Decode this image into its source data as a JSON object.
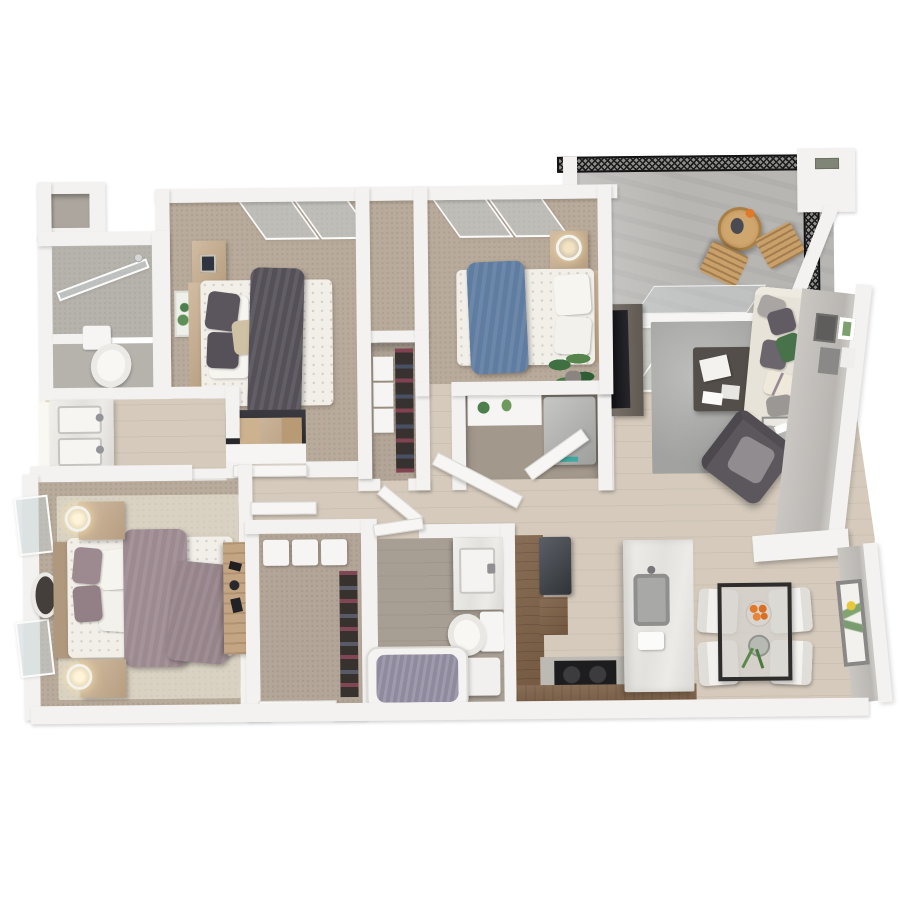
{
  "meta": {
    "title": "3D top-down floor plan render — apartment with three bedrooms, two bathrooms, balcony, open kitchen and living-dining area",
    "render_type": "architectural-3d-floorplan",
    "visible_text": "none"
  },
  "palette": {
    "background": "#ffffff",
    "wall": "#f3f2f0",
    "bedroom_carpet": "#b9ab9b",
    "hall_living_wood": "#d5cabc",
    "bathroom_plank": "#a89f94",
    "balcony_concrete": "#b7b6b3",
    "living_rug": "#a2a2a0",
    "master_rug": "#d9d2c3",
    "kitchen_cabinet_wood": "#7b5d43",
    "island_marble": "#eceae6",
    "appliance_dark": "#3c4046",
    "bed1_throw_charcoal": "#555058",
    "bed2_throw_blue": "#5f7da1",
    "master_throw_mauve": "#9c8a90",
    "sofa_cream": "#e8e3d8",
    "accent_green": "#47724a",
    "furniture_wood": "#c6ab8b",
    "glass": "#c5cfd3",
    "railing_mesh": "#1c1c1c",
    "orange_accent": "#e0792a",
    "tub_mat_purple": "#8f8b9e"
  },
  "rooms": [
    {
      "id": "bedroom-1",
      "label": "Bedroom 1 (top left)",
      "floor": "carpet",
      "furniture": [
        "double bed with charcoal draped throw",
        "two dark gray pillows",
        "tan pillow",
        "wood headboard",
        "nightstand with clock",
        "green wall art",
        "wood shelf with green box",
        "desk with dark top and wood organizers",
        "white sliding closet door",
        "two slanted window panes"
      ]
    },
    {
      "id": "bedroom-2",
      "label": "Bedroom 2 (top middle)",
      "floor": "carpet",
      "furniture": [
        "double bed with blue draped throw",
        "white pillows",
        "wood headboard",
        "nightstand with glowing lamp",
        "potted green plant",
        "two slanted window panes"
      ]
    },
    {
      "id": "balcony",
      "label": "Balcony (top right)",
      "floor": "concrete",
      "furniture": [
        "black mesh railing",
        "round wood bistro table with vase and orange",
        "two wood slat chairs",
        "white column with vent",
        "sliding glass door"
      ]
    },
    {
      "id": "living-room",
      "label": "Living room (right)",
      "floor": "wood",
      "furniture": [
        "gray area rug",
        "cream sofa with gray and green pillows",
        "dark gray armchair",
        "dark coffee table with magazines",
        "glass side table with candle",
        "TV on dark media console",
        "picture frames on right wall"
      ]
    },
    {
      "id": "hallway",
      "label": "Central hallway",
      "floor": "wood",
      "furniture": [
        "laundry closet with washer-dryer and plant shelf",
        "two open closet doors",
        "linen closet with white boxes and hanging clothes",
        "open closet door"
      ]
    },
    {
      "id": "bathroom-shower",
      "label": "Left bathroom stack",
      "floor": "tile",
      "furniture": [
        "storage niche",
        "walk-in shower with glass panel",
        "toilet",
        "marble double-sink vanity with lit mirror"
      ]
    },
    {
      "id": "master-bedroom",
      "label": "Master bedroom (bottom left)",
      "floor": "carpet",
      "furniture": [
        "bed with mauve throw and pillows",
        "wood headboard",
        "round dark wall mirror",
        "two nightstands with lit lamps",
        "cream area rug",
        "wood desk with black accessories",
        "two window panes",
        "open door to hall"
      ]
    },
    {
      "id": "entry-closet",
      "label": "Entry walk-in closet (bottom center)",
      "floor": "carpet",
      "furniture": [
        "three white shelf boxes",
        "hanging clothes rail",
        "open white entry door"
      ]
    },
    {
      "id": "bathroom-2",
      "label": "Bathroom 2 (bottom center)",
      "floor": "gray plank",
      "furniture": [
        "marble vanity with sink",
        "toilet",
        "white side stool",
        "bathtub with purple mat"
      ]
    },
    {
      "id": "kitchen",
      "label": "Kitchen (bottom center-right)",
      "floor": "wood",
      "furniture": [
        "U-shaped walnut cabinets",
        "dark refrigerator",
        "black cooktop with two burners",
        "white marble island with gray sink and tray"
      ]
    },
    {
      "id": "dining",
      "label": "Dining area (bottom right)",
      "floor": "wood",
      "furniture": [
        "black-frame glass dining table",
        "bowl of oranges",
        "glass vase with greenery",
        "four white chairs",
        "white console shelf",
        "botanical wall art with yellow flower"
      ]
    }
  ]
}
